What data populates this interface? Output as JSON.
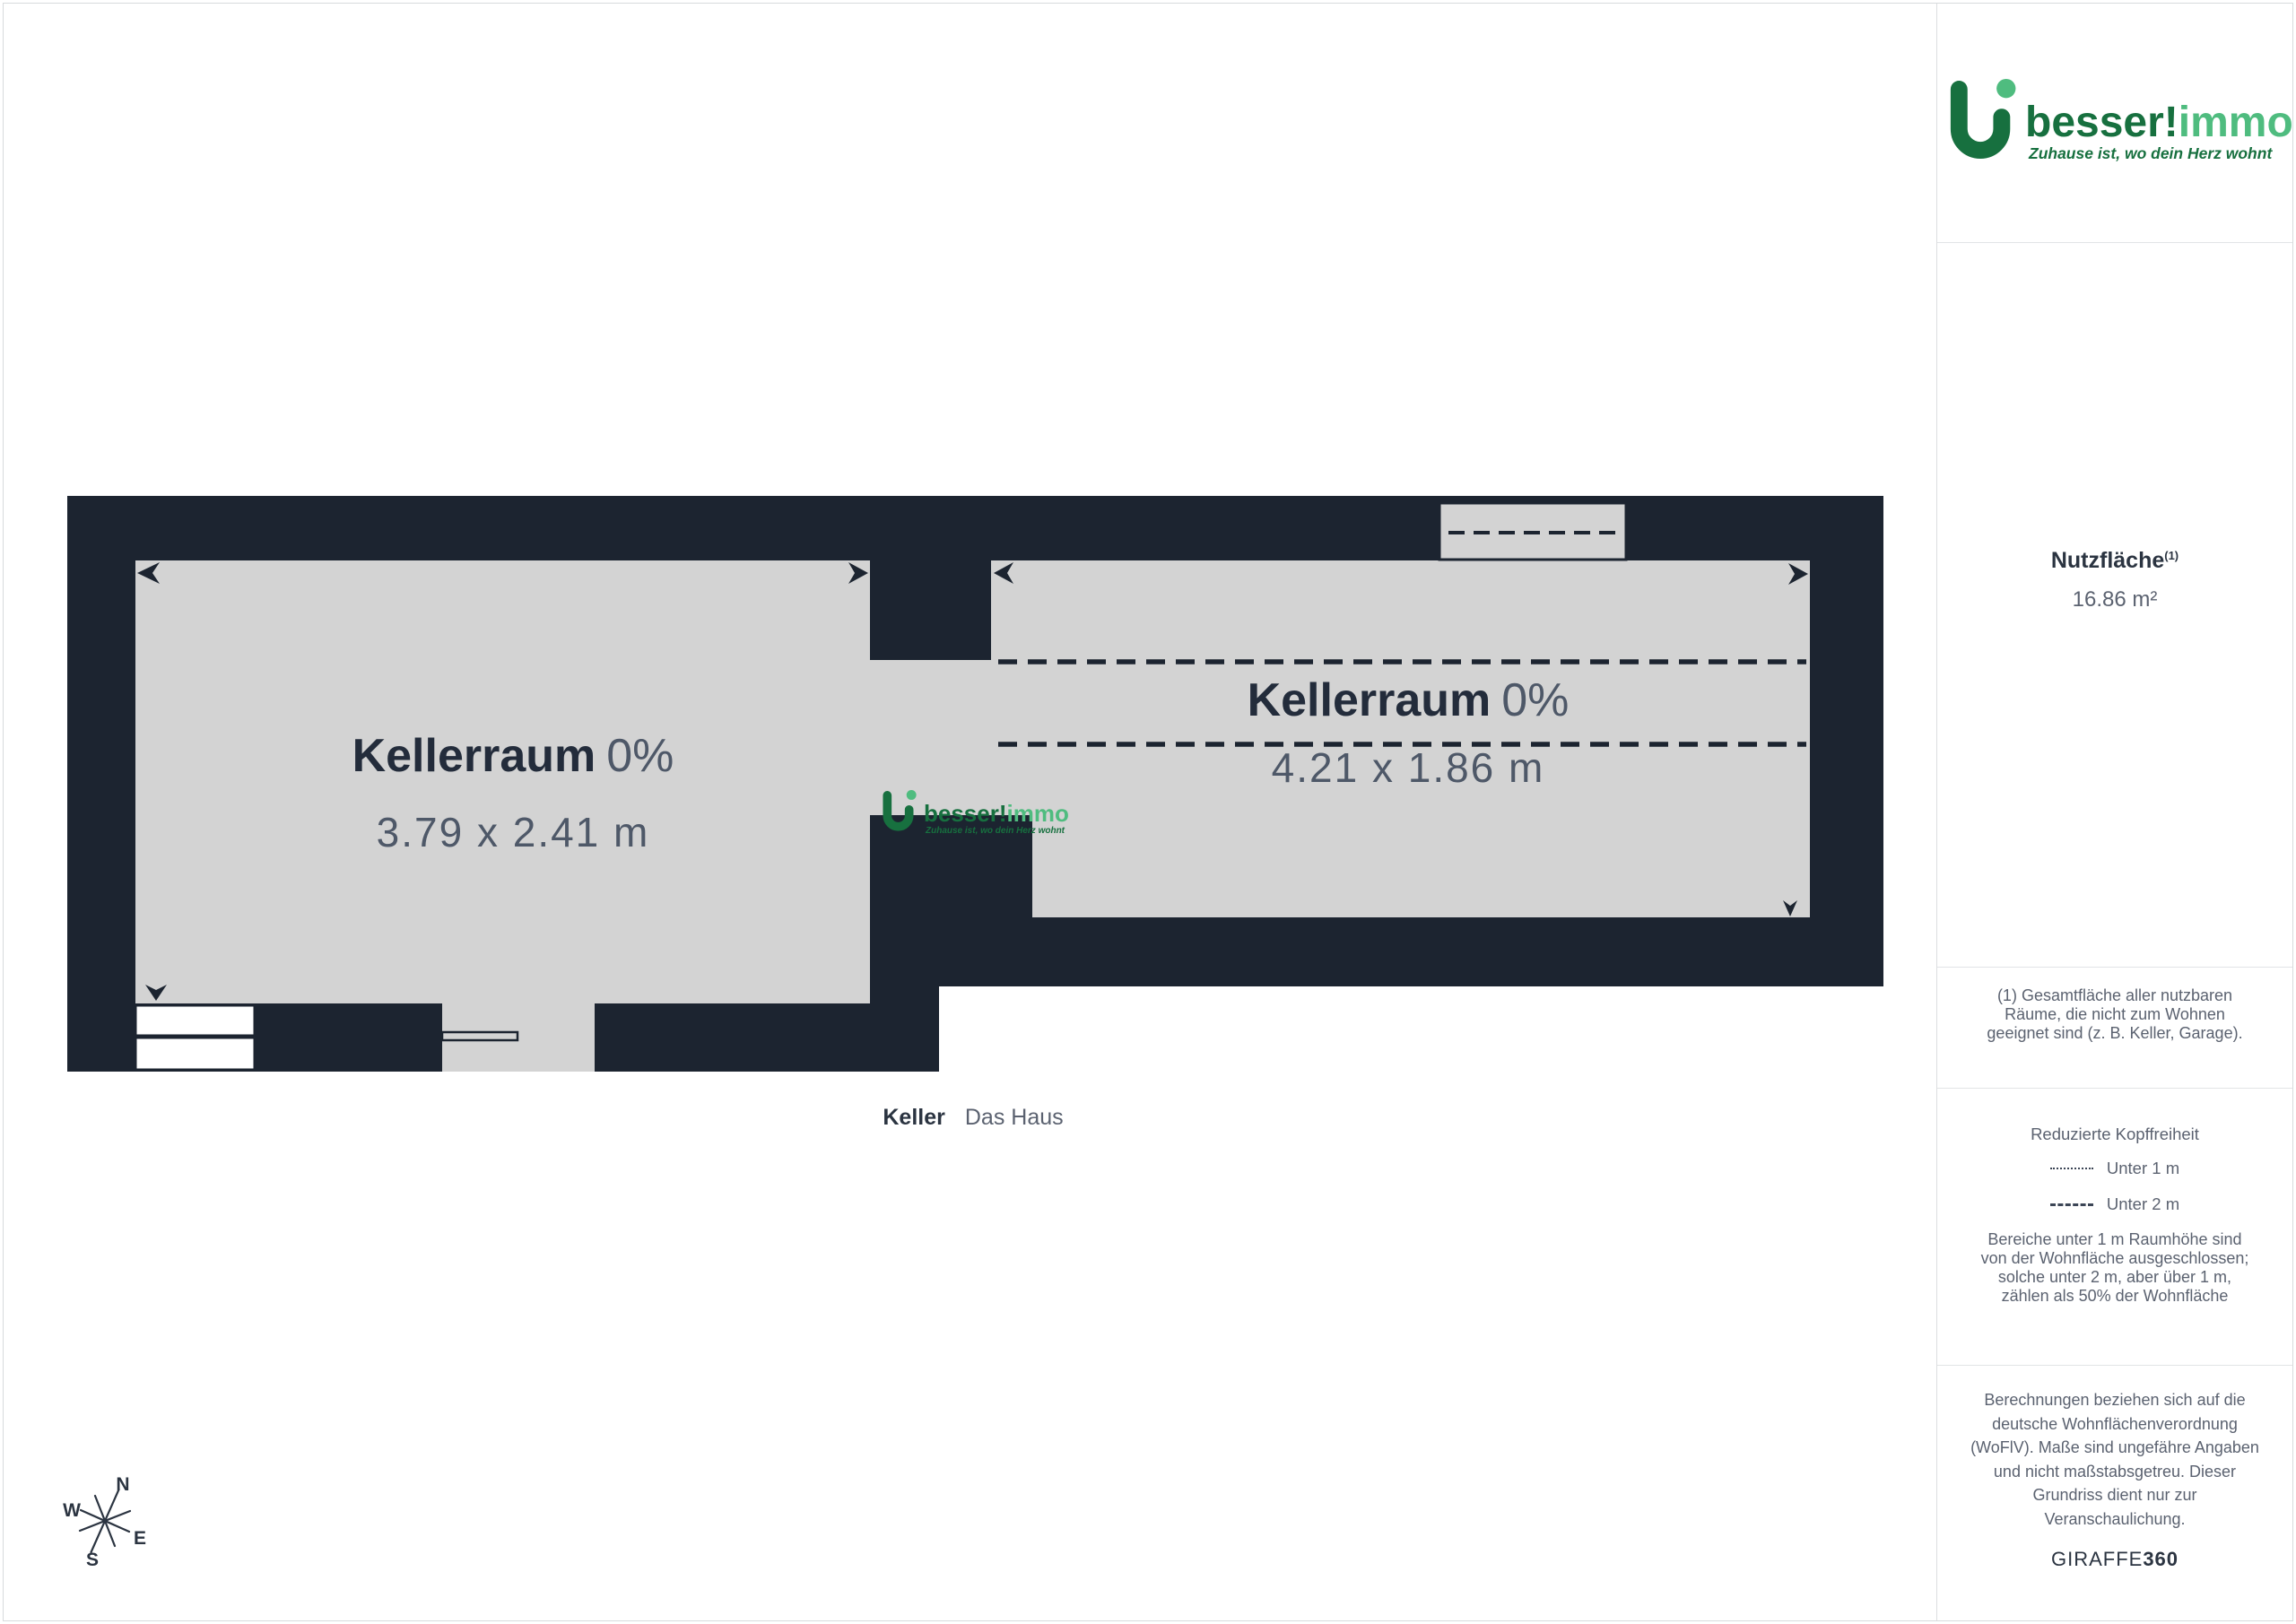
{
  "colors": {
    "wall": "#1c2430",
    "floor": "#d3d3d3",
    "brand_dark_green": "#17703f",
    "brand_light_green": "#4fbc7f",
    "heading_text": "#2b3441",
    "body_text": "#5b6270"
  },
  "sidebar": {
    "logo": {
      "brand_dark_part": "besser!",
      "brand_light_part": "immo",
      "tagline": "Zuhause ist, wo dein Herz wohnt"
    },
    "area": {
      "title": "Nutzfläche",
      "footnote_ref": "(1)",
      "value": "16.86 m²"
    },
    "footnote": "(1) Gesamtfläche aller nutzbaren\nRäume, die nicht zum Wohnen\ngeeignet sind (z. B. Keller, Garage).",
    "headroom": {
      "title": "Reduzierte Kopffreiheit",
      "under_1m": "Unter 1 m",
      "under_2m": "Unter 2 m",
      "note": "Bereiche unter 1 m Raumhöhe sind\nvon der Wohnfläche ausgeschlossen;\nsolche unter 2 m, aber über 1 m,\nzählen als 50% der Wohnfläche"
    },
    "disclaimer": "Berechnungen beziehen sich auf die\ndeutsche Wohnflächenverordnung\n(WoFlV). Maße sind ungefähre Angaben\nund nicht maßstabsgetreu. Dieser\nGrundriss dient nur zur\nVeranschaulichung.",
    "brand_footer": {
      "normal": "GIRAFFE",
      "bold": "360"
    }
  },
  "plan": {
    "room_left": {
      "name": "Kellerraum",
      "share": "0%",
      "dims": "3.79 x 2.41 m"
    },
    "room_right": {
      "name": "Kellerraum",
      "share": "0%",
      "dims": "4.21 x 1.86 m"
    },
    "caption": {
      "level": "Keller",
      "project": "Das Haus"
    },
    "compass": {
      "n": "N",
      "e": "E",
      "s": "S",
      "w": "W"
    },
    "watermark": {
      "brand_dark_part": "besser!",
      "brand_light_part": "immo",
      "tagline": "Zuhause ist, wo dein Herz wohnt"
    }
  }
}
